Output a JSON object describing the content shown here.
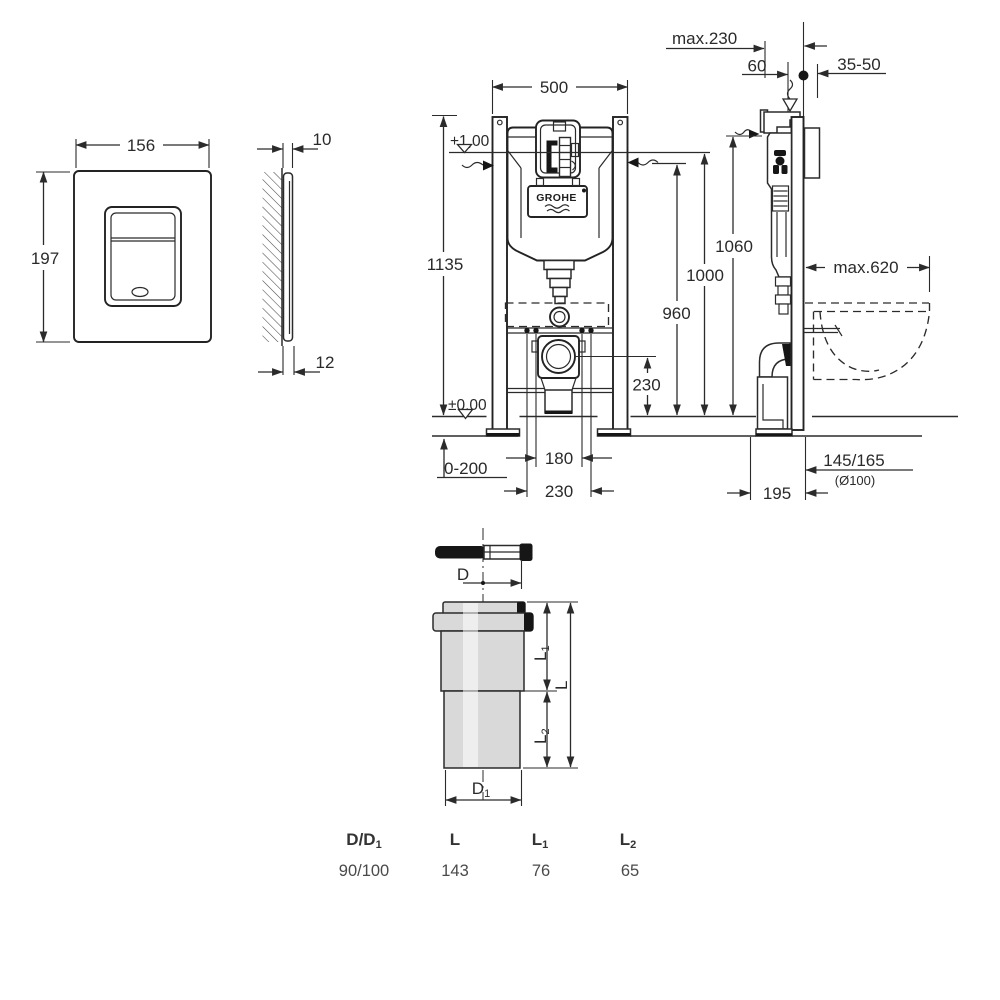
{
  "plate_front": {
    "dim_width": "156",
    "dim_height": "197"
  },
  "plate_side": {
    "dim_top": "10",
    "dim_bottom": "12"
  },
  "frame_front": {
    "dim_width": "500",
    "dim_total_height": "1135",
    "level_top": "+1,00",
    "level_floor": "±0,00",
    "dim_height_1000": "1000",
    "dim_height_960": "960",
    "dim_outlet_height": "230",
    "dim_floor_buildup": "0-200",
    "dim_bolt_180": "180",
    "dim_bolt_230": "230",
    "brand": "GROHE"
  },
  "frame_side": {
    "dim_depth_max": "max.230",
    "dim_60": "60",
    "dim_wall_thickness": "35-50",
    "dim_height_1060": "1060",
    "dim_bowl_depth_max": "max.620",
    "dim_outlet_offset": "145/165",
    "dim_outlet_diameter": "(Ø100)",
    "dim_foot_depth": "195"
  },
  "connector": {
    "dim_d": {
      "base": "D",
      "sub": ""
    },
    "dim_d1": {
      "base": "D",
      "sub": "1"
    },
    "dim_l": {
      "base": "L",
      "sub": ""
    },
    "dim_l1": {
      "base": "L",
      "sub": "1"
    },
    "dim_l2": {
      "base": "L",
      "sub": "2"
    }
  },
  "connector_table": {
    "headers": [
      {
        "base": "D/D",
        "sub": "1"
      },
      {
        "base": "L",
        "sub": ""
      },
      {
        "base": "L",
        "sub": "1"
      },
      {
        "base": "L",
        "sub": "2"
      }
    ],
    "values": [
      "90/100",
      "143",
      "76",
      "65"
    ]
  },
  "colors": {
    "line": "#2b2b2b",
    "fill_gray": "#d9d9d9",
    "text": "#2a2a2a"
  }
}
